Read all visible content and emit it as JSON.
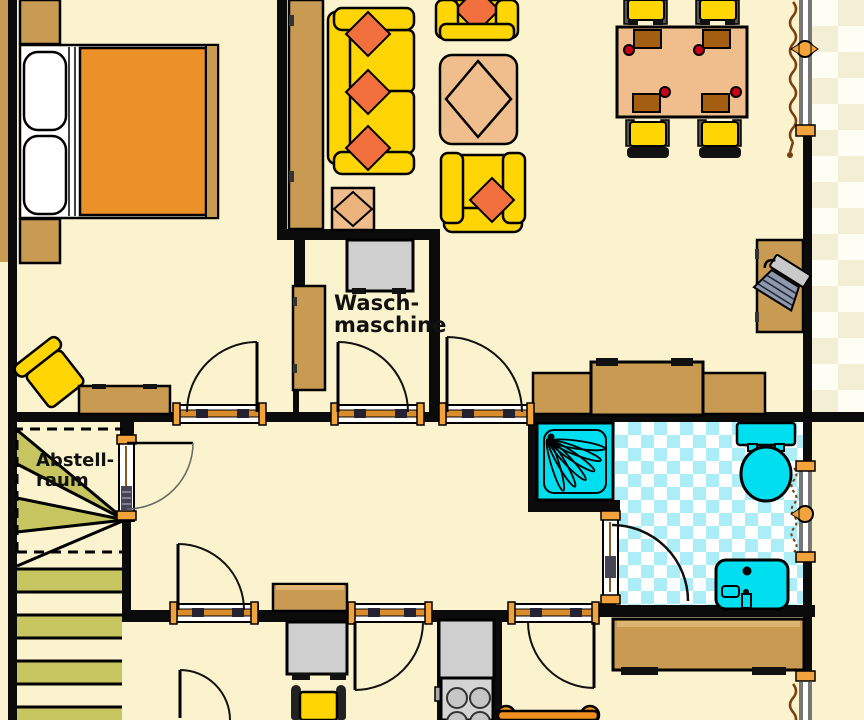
{
  "floorplan": {
    "labels": {
      "washing_machine_line1": "Wasch-",
      "washing_machine_line2": "maschine",
      "storage_room_line1": "Abstell-",
      "storage_room_line2": "raum"
    },
    "colors": {
      "floor": "#FBF3CE",
      "wall": "#0B0B0B",
      "wood": "#C89A52",
      "wood_light": "#DDB471",
      "yellow": "#FFD503",
      "cushion": "#F2703E",
      "tan_table": "#F0BE8D",
      "mat_brown": "#A35E11",
      "mattress": "#EC9127",
      "appliance_gray": "#CFCFCF",
      "cyan": "#00DFF0",
      "tile_cyan": "#ACEEF8",
      "olive": "#C6C55F",
      "checker_pale": "#F2EFD4",
      "checker_white": "#FFFEF4",
      "threshold_bar": "#D98C2B",
      "knob_orange": "#F2A33C",
      "curtain": "#7B3F10",
      "red_dot": "#C9001B",
      "chair_post": "#555555",
      "dark": "#111111"
    }
  }
}
